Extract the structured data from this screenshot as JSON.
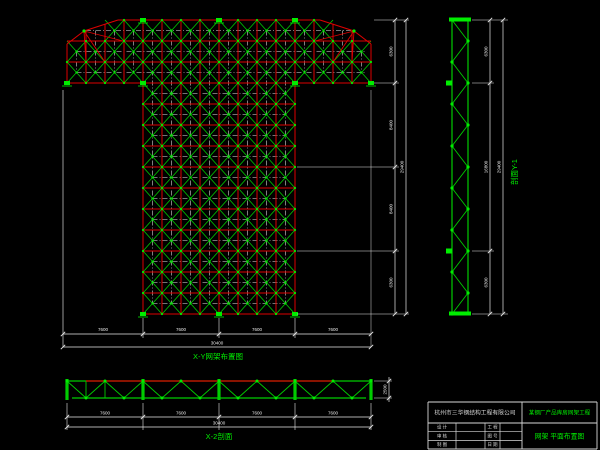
{
  "app": {
    "description": "CAD drawing - space frame (grid shell) structural layout",
    "background": "#000000"
  },
  "colors": {
    "chord_red": "#dd0000",
    "member_green": "#00cc00",
    "node_green": "#00ee00",
    "dim_white": "#e8e8e8",
    "ext_gray": "#8a8a8a",
    "label_green": "#00ee00",
    "table_white": "#d8d8d8"
  },
  "plan_view": {
    "title": "X-Y网架布置图",
    "dim_bottom": {
      "segments": [
        "7600",
        "7600",
        "7600",
        "7600"
      ],
      "total": "30400"
    },
    "dim_right": {
      "segments": [
        "6300",
        "8400",
        "8400",
        "6300"
      ],
      "total": "29400"
    }
  },
  "section_y1": {
    "title": "剖面Y-1",
    "dim": {
      "segments": [
        "6300",
        "16800",
        "6300"
      ],
      "total": "29400"
    }
  },
  "section_x2": {
    "title": "X-2剖面",
    "dim": {
      "segments": [
        "7600",
        "7600",
        "7600",
        "7600"
      ],
      "total": "30400",
      "height": "2500"
    }
  },
  "title_block": {
    "company": "杭州市三华钢结构工程有限公司",
    "project": "某钢厂产品库房网架工程",
    "drawing_name": "网架 平面布置图",
    "rows": [
      {
        "label": "设 计",
        "field": "工 程"
      },
      {
        "label": "审 核",
        "field": "图 号"
      },
      {
        "label": "制 图",
        "field": "日 期"
      }
    ]
  }
}
